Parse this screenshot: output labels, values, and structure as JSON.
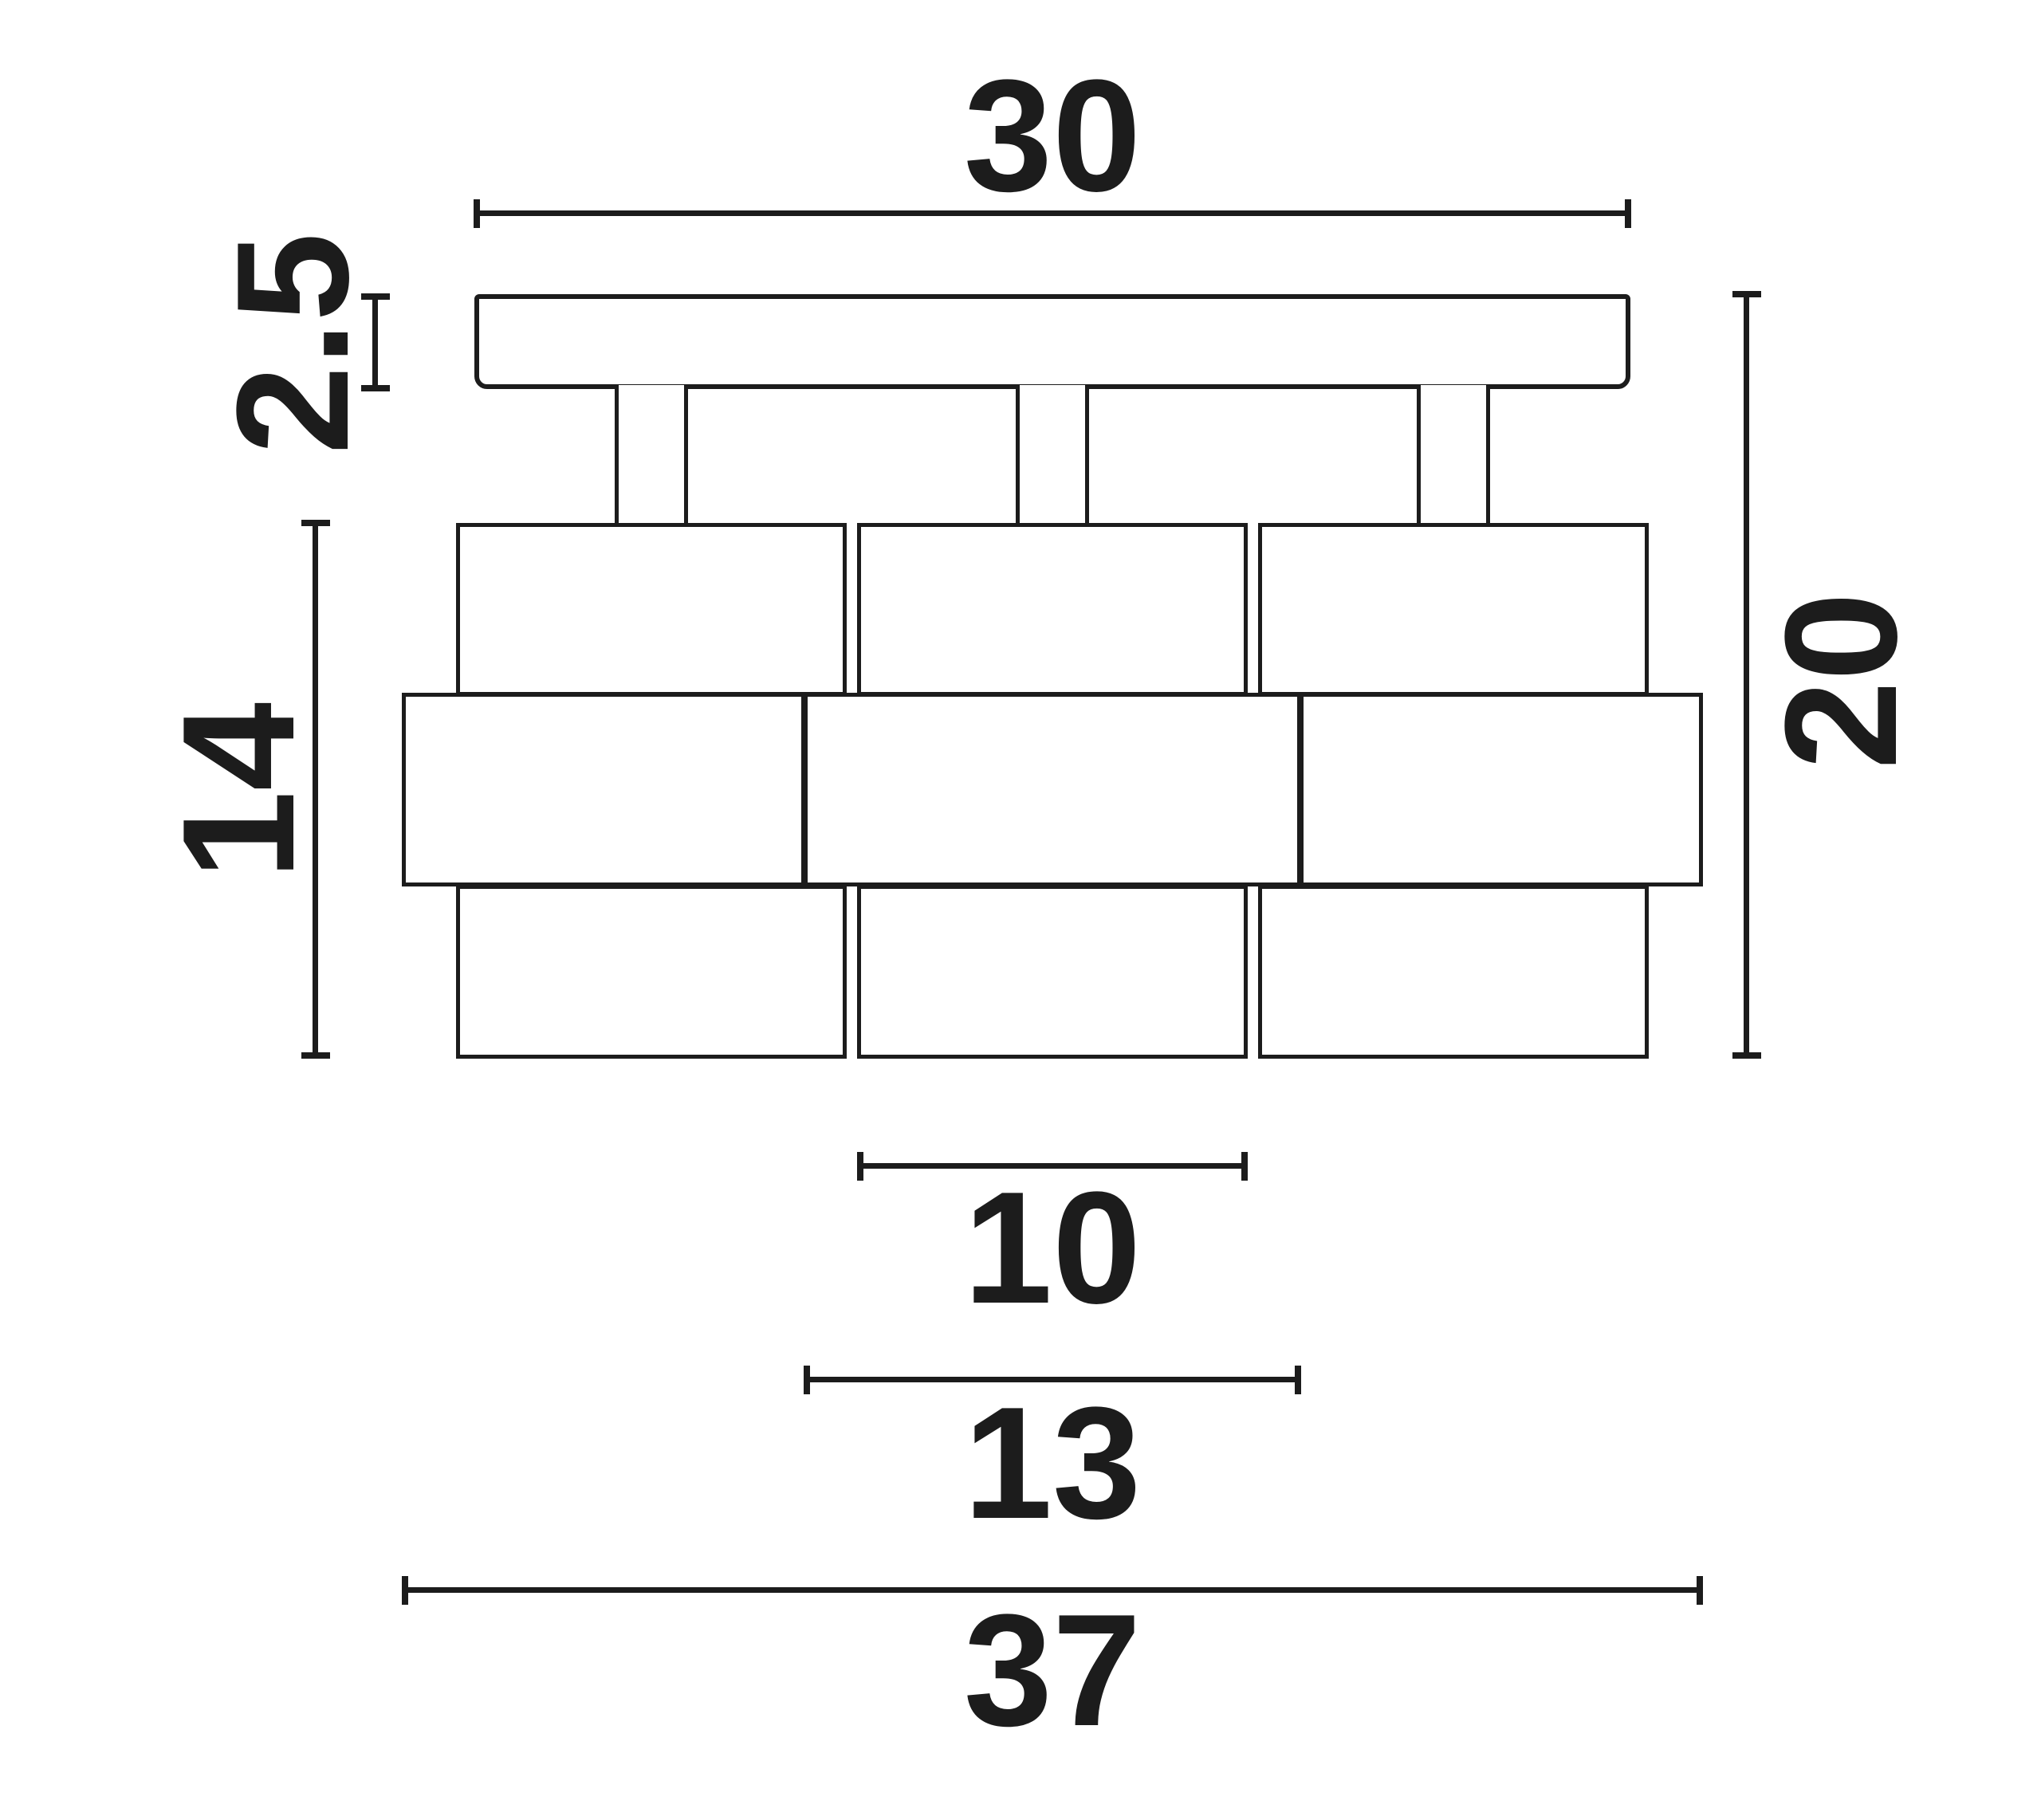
{
  "drawing": {
    "type": "technical-dimension-drawing",
    "subject": "three-shade ceiling light, front elevation",
    "background_color": "#ffffff",
    "ink_color": "#1c1c1c"
  },
  "dimensions": {
    "plate_width": "30",
    "plate_thickness": "2.5",
    "shade_height": "14",
    "total_height": "20",
    "band_width": "10",
    "middle_band_width": "13",
    "overall_width": "37"
  }
}
